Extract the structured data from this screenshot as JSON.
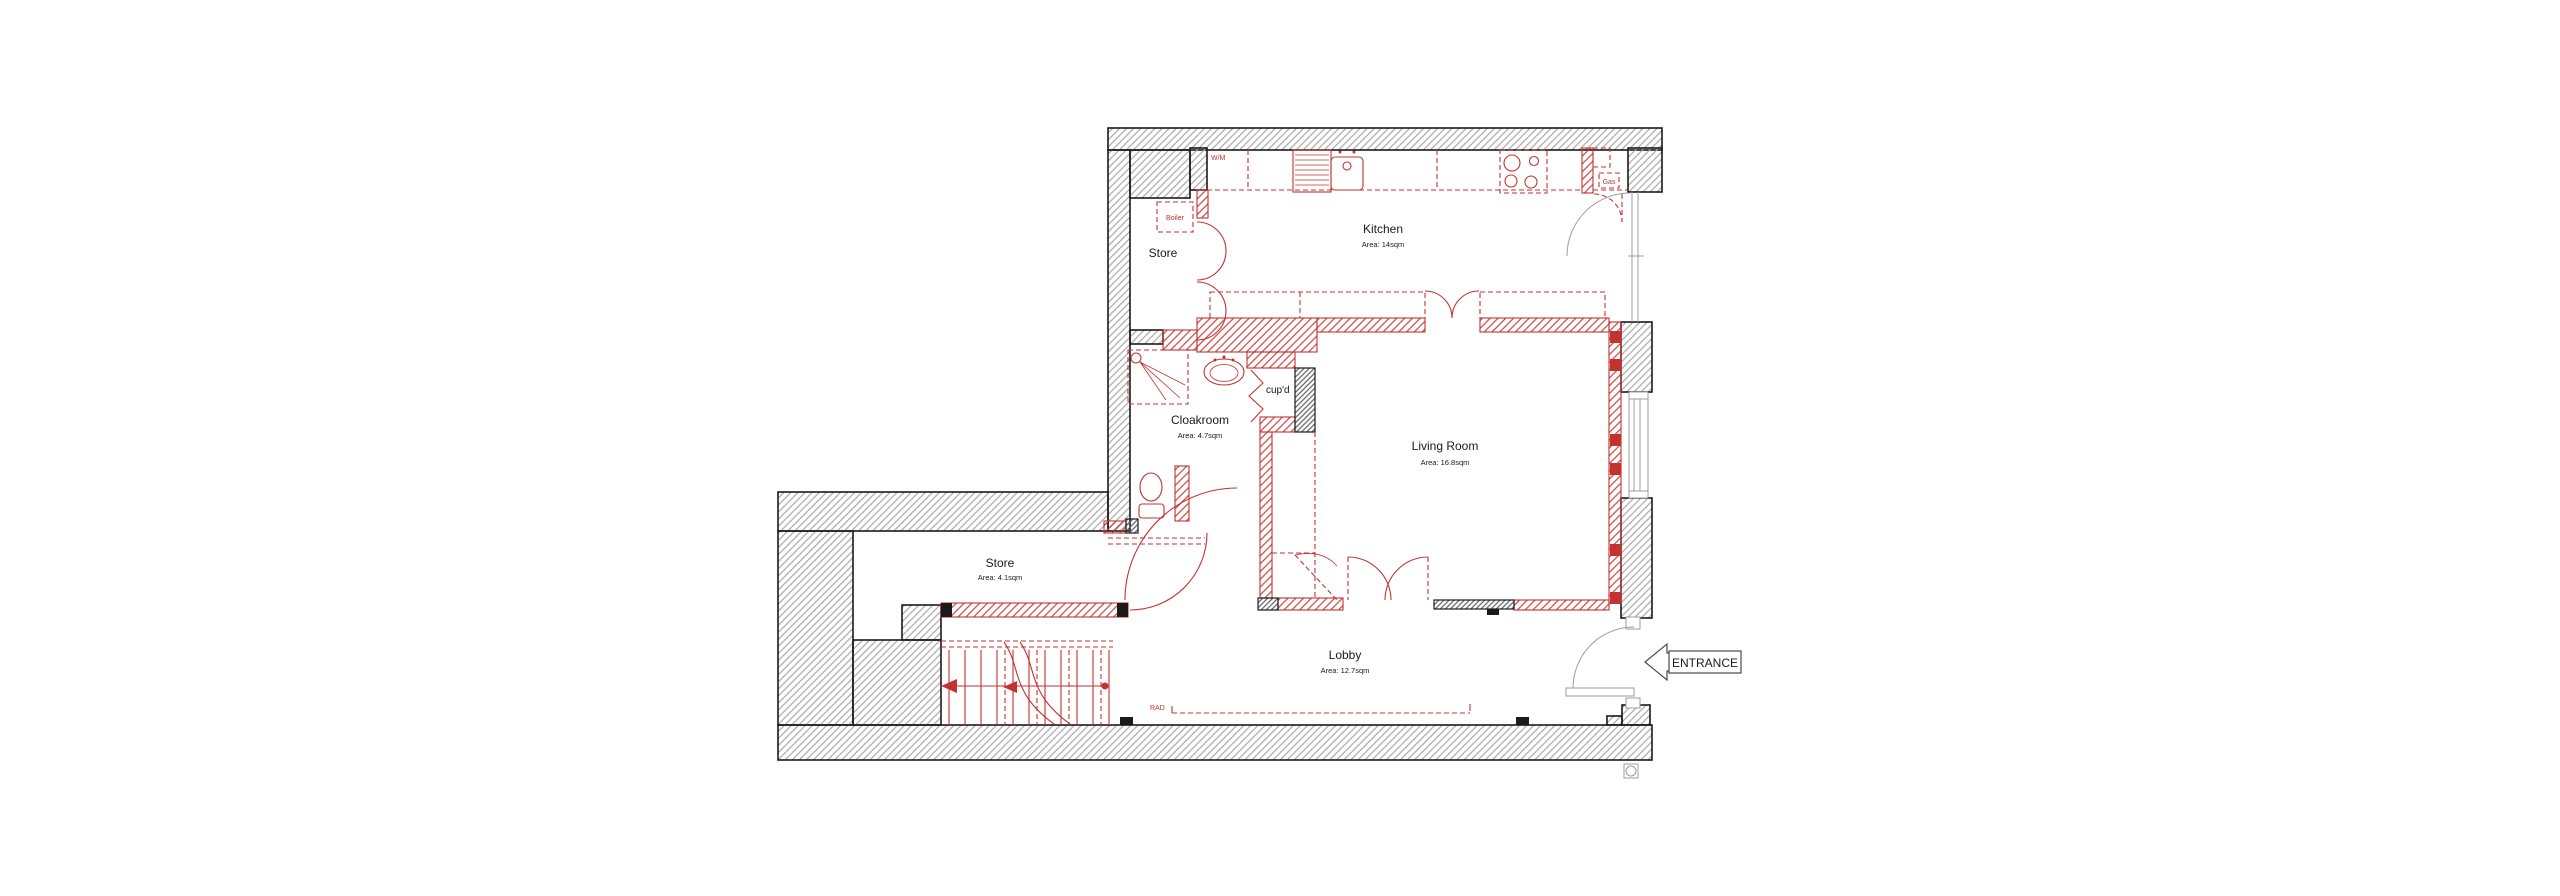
{
  "plan": {
    "rooms": {
      "kitchen": {
        "name": "Kitchen",
        "area": "Area: 14sqm"
      },
      "store_upper": {
        "name": "Store"
      },
      "cloakroom": {
        "name": "Cloakroom",
        "area": "Area: 4.7sqm"
      },
      "living_room": {
        "name": "Living Room",
        "area": "Area: 16.8sqm"
      },
      "store_lower": {
        "name": "Store",
        "area": "Area: 4.1sqm"
      },
      "lobby": {
        "name": "Lobby",
        "area": "Area: 12.7sqm"
      }
    },
    "fixtures": {
      "washing_machine": "W/M",
      "boiler": "Boiler",
      "gas_meter": "Gas",
      "cupboard": "cup'd",
      "radiator": "RAD"
    },
    "entrance_label": "ENTRANCE",
    "colors": {
      "red": "#c23330",
      "wall_hatch": "#a8a8a8",
      "outline": "#1a1a1a",
      "light_grey": "#9c9c9c",
      "dark_hatch": "#606060"
    }
  }
}
